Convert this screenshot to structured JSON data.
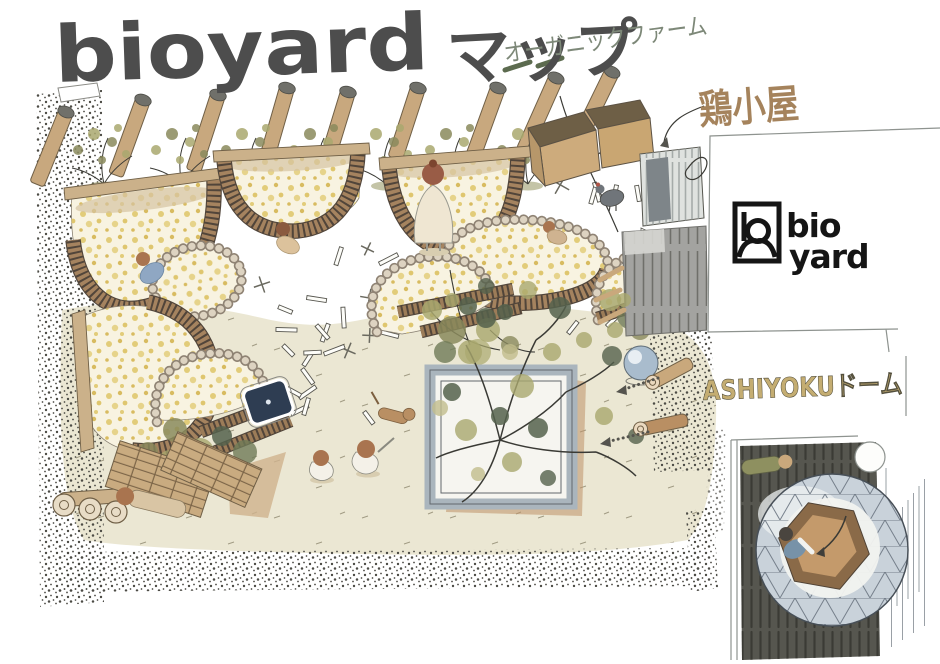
{
  "poster": {
    "title_latin": "bioyard",
    "title_kana": "マップ"
  },
  "labels": {
    "organic_farm": "オーガニックファーム",
    "chicken_coop": "鶏小屋",
    "ashiyoku_dome": "ASHIYOKUドーム"
  },
  "logo": {
    "line1": "bio",
    "line2": "yard"
  },
  "palette": {
    "ink": "#3a3a35",
    "paper": "#ffffff",
    "ground_cream": "#ebe7d3",
    "bed_fill": "#f8f3e1",
    "flower_yellow": "#e2cc79",
    "wood_dark": "#51453a",
    "wood": "#a5835f",
    "wood_light": "#cbb18a",
    "stone": "#8f8374",
    "olive": "#a9a86e",
    "green_dark": "#55624c",
    "gravel": "#4c4b45",
    "fence_gray": "#a3a3a0",
    "hut_gray": "#dfe2df",
    "planter_frame": "#aab5bd",
    "dome_blue": "#c9d2da",
    "deck_dark": "#56564f",
    "water_navy": "#2e3d52",
    "skin": "#a9744f",
    "shirt_blue": "#8fa7c3",
    "dress_cream": "#efe6d2",
    "label_green": "#7d8878",
    "label_brown": "#a5835c",
    "label_tan": "#c4ad72",
    "logo_black": "#151515"
  },
  "scene": {
    "features": [
      "angled-wood-posts-with-saplings",
      "raised-garden-beds",
      "stone-ring-beds",
      "compost-boxes",
      "chicken-coop-hut",
      "chicken",
      "plank-fence",
      "central-square-tree-planter",
      "garden-ball",
      "spiral-logs",
      "log-stack",
      "plank-loungers",
      "water-basin",
      "children-playing",
      "dog",
      "gardeners",
      "gravel-paths",
      "geodesic-foot-bath-dome",
      "wood-deck",
      "bather-in-dome"
    ]
  }
}
